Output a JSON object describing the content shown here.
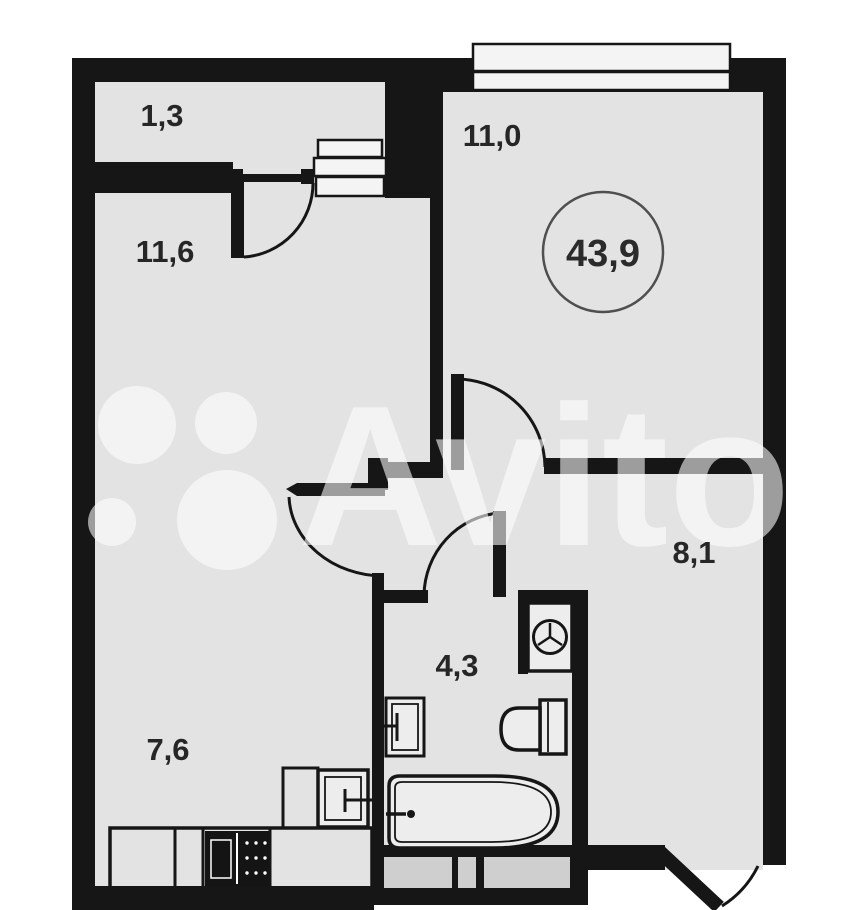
{
  "title": "Floor plan of 1-room apartment",
  "watermark": {
    "brand": "Avito"
  },
  "total": {
    "value": "43,9"
  },
  "rooms": [
    {
      "id": "balcony",
      "area": "1,3"
    },
    {
      "id": "living-room",
      "area": "11,6"
    },
    {
      "id": "bedroom",
      "area": "11,0"
    },
    {
      "id": "kitchen",
      "area": "7,6"
    },
    {
      "id": "bathroom",
      "area": "4,3"
    },
    {
      "id": "hallway",
      "area": "8,1"
    }
  ],
  "colors": {
    "wall": "#161616",
    "floor": "#e3e3e3",
    "outside": "#ffffff",
    "fixture": "#ededed",
    "window": "#f4f4f4",
    "label": "#262626",
    "watermark": "#ffffff"
  }
}
